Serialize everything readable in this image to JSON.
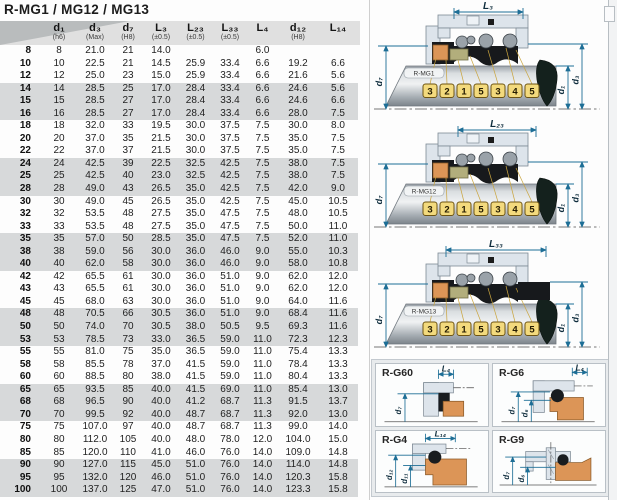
{
  "title": "R-MG1 / MG12 / MG13",
  "colors": {
    "dimension_accent": "#1d6e96",
    "band_gray": "#d7d9da",
    "header_gray": "#e0e0e0",
    "header_corner": "#b9bcbd",
    "tag_yellow": "#f3da7d",
    "seat_orange": "#dc9557",
    "olive_ring": "#b2ae7c",
    "housing_blue_gray": "#dde4eb"
  },
  "table": {
    "columns": [
      {
        "label": "",
        "sub": ""
      },
      {
        "label": "d₁",
        "sub": "(h6)"
      },
      {
        "label": "d₃",
        "sub": "(Max)"
      },
      {
        "label": "d₇",
        "sub": "(H8)"
      },
      {
        "label": "L₃",
        "sub": "(±0.5)"
      },
      {
        "label": "L₂₃",
        "sub": "(±0.5)"
      },
      {
        "label": "L₃₃",
        "sub": "(±0.5)"
      },
      {
        "label": "L₄",
        "sub": ""
      },
      {
        "label": "d₁₂",
        "sub": "(H8)"
      },
      {
        "label": "L₁₄",
        "sub": ""
      }
    ],
    "rows": [
      [
        "8",
        "8",
        "21.0",
        "21",
        "14.0",
        "",
        "",
        "6.0",
        "",
        ""
      ],
      [
        "10",
        "10",
        "22.5",
        "21",
        "14.5",
        "25.9",
        "33.4",
        "6.6",
        "19.2",
        "6.6"
      ],
      [
        "12",
        "12",
        "25.0",
        "23",
        "15.0",
        "25.9",
        "33.4",
        "6.6",
        "21.6",
        "5.6"
      ],
      [
        "14",
        "14",
        "28.5",
        "25",
        "17.0",
        "28.4",
        "33.4",
        "6.6",
        "24.6",
        "5.6"
      ],
      [
        "15",
        "15",
        "28.5",
        "27",
        "17.0",
        "28.4",
        "33.4",
        "6.6",
        "24.6",
        "6.6"
      ],
      [
        "16",
        "16",
        "28.5",
        "27",
        "17.0",
        "28.4",
        "33.4",
        "6.6",
        "28.0",
        "7.5"
      ],
      [
        "18",
        "18",
        "32.0",
        "33",
        "19.5",
        "30.0",
        "37.5",
        "7.5",
        "30.0",
        "8.0"
      ],
      [
        "20",
        "20",
        "37.0",
        "35",
        "21.5",
        "30.0",
        "37.5",
        "7.5",
        "35.0",
        "7.5"
      ],
      [
        "22",
        "22",
        "37.0",
        "37",
        "21.5",
        "30.0",
        "37.5",
        "7.5",
        "35.0",
        "7.5"
      ],
      [
        "24",
        "24",
        "42.5",
        "39",
        "22.5",
        "32.5",
        "42.5",
        "7.5",
        "38.0",
        "7.5"
      ],
      [
        "25",
        "25",
        "42.5",
        "40",
        "23.0",
        "32.5",
        "42.5",
        "7.5",
        "38.0",
        "7.5"
      ],
      [
        "28",
        "28",
        "49.0",
        "43",
        "26.5",
        "35.0",
        "42.5",
        "7.5",
        "42.0",
        "9.0"
      ],
      [
        "30",
        "30",
        "49.0",
        "45",
        "26.5",
        "35.0",
        "42.5",
        "7.5",
        "45.0",
        "10.5"
      ],
      [
        "32",
        "32",
        "53.5",
        "48",
        "27.5",
        "35.0",
        "47.5",
        "7.5",
        "48.0",
        "10.5"
      ],
      [
        "33",
        "33",
        "53.5",
        "48",
        "27.5",
        "35.0",
        "47.5",
        "7.5",
        "50.0",
        "11.0"
      ],
      [
        "35",
        "35",
        "57.0",
        "50",
        "28.5",
        "35.0",
        "47.5",
        "7.5",
        "52.0",
        "11.0"
      ],
      [
        "38",
        "38",
        "59.0",
        "56",
        "30.0",
        "36.0",
        "46.0",
        "9.0",
        "55.0",
        "10.3"
      ],
      [
        "40",
        "40",
        "62.0",
        "58",
        "30.0",
        "36.0",
        "46.0",
        "9.0",
        "58.0",
        "10.8"
      ],
      [
        "42",
        "42",
        "65.5",
        "61",
        "30.0",
        "36.0",
        "51.0",
        "9.0",
        "62.0",
        "12.0"
      ],
      [
        "43",
        "43",
        "65.5",
        "61",
        "30.0",
        "36.0",
        "51.0",
        "9.0",
        "62.0",
        "12.0"
      ],
      [
        "45",
        "45",
        "68.0",
        "63",
        "30.0",
        "36.0",
        "51.0",
        "9.0",
        "64.0",
        "11.6"
      ],
      [
        "48",
        "48",
        "70.5",
        "66",
        "30.5",
        "36.0",
        "51.0",
        "9.0",
        "68.4",
        "11.6"
      ],
      [
        "50",
        "50",
        "74.0",
        "70",
        "30.5",
        "38.0",
        "50.5",
        "9.5",
        "69.3",
        "11.6"
      ],
      [
        "53",
        "53",
        "78.5",
        "73",
        "33.0",
        "36.5",
        "59.0",
        "11.0",
        "72.3",
        "12.3"
      ],
      [
        "55",
        "55",
        "81.0",
        "75",
        "35.0",
        "36.5",
        "59.0",
        "11.0",
        "75.4",
        "13.3"
      ],
      [
        "58",
        "58",
        "85.5",
        "78",
        "37.0",
        "41.5",
        "59.0",
        "11.0",
        "78.4",
        "13.3"
      ],
      [
        "60",
        "60",
        "88.5",
        "80",
        "38.0",
        "41.5",
        "59.0",
        "11.0",
        "80.4",
        "13.3"
      ],
      [
        "65",
        "65",
        "93.5",
        "85",
        "40.0",
        "41.5",
        "69.0",
        "11.0",
        "85.4",
        "13.0"
      ],
      [
        "68",
        "68",
        "96.5",
        "90",
        "40.0",
        "41.2",
        "68.7",
        "11.3",
        "91.5",
        "13.7"
      ],
      [
        "70",
        "70",
        "99.5",
        "92",
        "40.0",
        "48.7",
        "68.7",
        "11.3",
        "92.0",
        "13.0"
      ],
      [
        "75",
        "75",
        "107.0",
        "97",
        "40.0",
        "48.7",
        "68.7",
        "11.3",
        "99.0",
        "14.0"
      ],
      [
        "80",
        "80",
        "112.0",
        "105",
        "40.0",
        "48.0",
        "78.0",
        "12.0",
        "104.0",
        "15.0"
      ],
      [
        "85",
        "85",
        "120.0",
        "110",
        "41.0",
        "46.0",
        "76.0",
        "14.0",
        "109.0",
        "14.8"
      ],
      [
        "90",
        "90",
        "127.0",
        "115",
        "45.0",
        "51.0",
        "76.0",
        "14.0",
        "114.0",
        "14.8"
      ],
      [
        "95",
        "95",
        "132.0",
        "120",
        "46.0",
        "51.0",
        "76.0",
        "14.0",
        "120.3",
        "15.8"
      ],
      [
        "100",
        "100",
        "137.0",
        "125",
        "47.0",
        "51.0",
        "76.0",
        "14.0",
        "123.3",
        "15.8"
      ]
    ]
  },
  "diagrams": [
    {
      "name": "R-MG1",
      "dim_top": "L₃",
      "dim_left": "d₇",
      "dim_right_inner": "d₁",
      "dim_right_outer": "d₃",
      "tags": [
        "3",
        "2",
        "1",
        "5",
        "3",
        "4",
        "5"
      ]
    },
    {
      "name": "R-MG12",
      "dim_top": "L₂₃",
      "dim_left": "d₇",
      "dim_right_inner": "d₁",
      "dim_right_outer": "d₃",
      "tags": [
        "3",
        "2",
        "1",
        "5",
        "3",
        "4",
        "5"
      ]
    },
    {
      "name": "R-MG13",
      "dim_top": "L₃₃",
      "dim_left": "d₇",
      "dim_right_inner": "d₁",
      "dim_right_outer": "d₃",
      "tags": [
        "3",
        "2",
        "1",
        "5",
        "3",
        "4",
        "5"
      ]
    }
  ],
  "panel": {
    "cards": [
      {
        "label": "R-G60",
        "dim_top": "L₄",
        "dim_labels": [
          "d₇"
        ]
      },
      {
        "label": "R-G6",
        "dim_top": "L₄",
        "dim_labels": [
          "d₇",
          "d₆"
        ]
      },
      {
        "label": "R-G4",
        "dim_top": "L₁₄",
        "dim_labels": [
          "d₁₂",
          "d₁₁"
        ]
      },
      {
        "label": "R-G9",
        "dim_top": "",
        "dim_labels": [
          "d₇",
          "d₆"
        ]
      }
    ]
  }
}
